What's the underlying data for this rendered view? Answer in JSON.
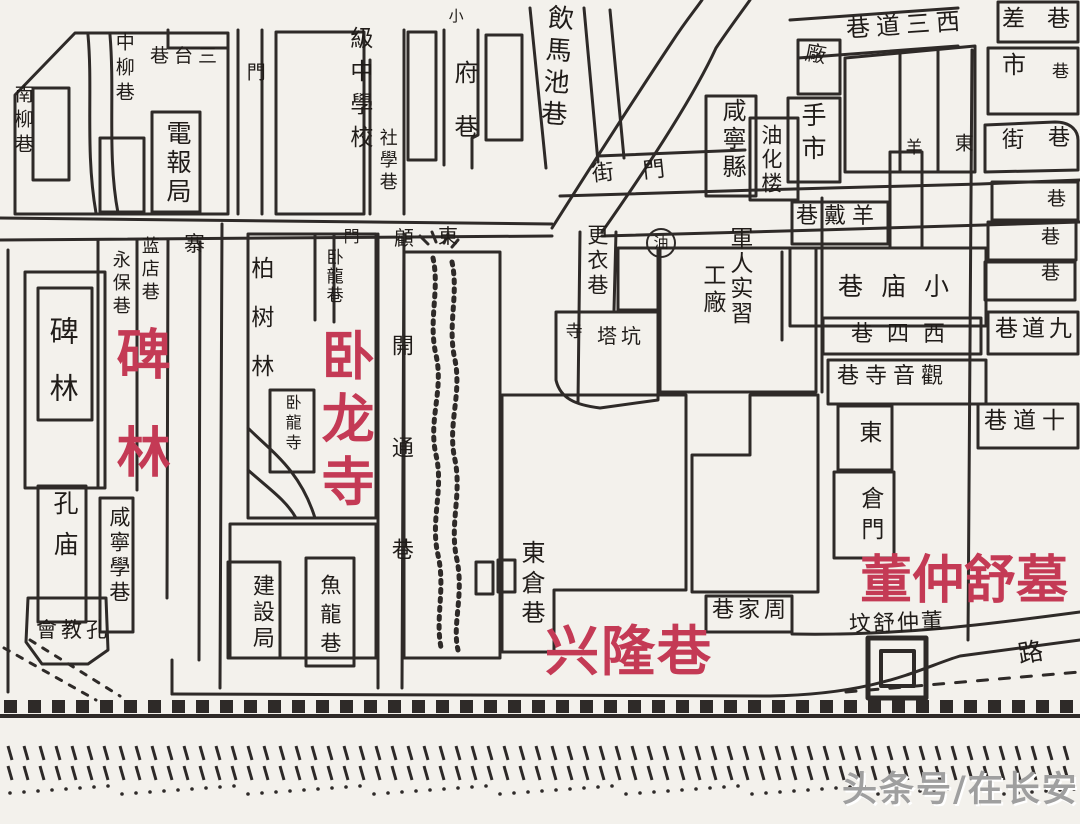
{
  "canvas": {
    "width": 1080,
    "height": 824
  },
  "colors": {
    "paper": "#f3f1ec",
    "ink": "#2e2a28",
    "label_ink": "#201c19",
    "red_annotation": "#c43a55",
    "watermark_gray": "#9f9f9f"
  },
  "watermark": {
    "text": "头条号/在长安"
  },
  "red_annotations": {
    "beilin": "碑林",
    "wolongsi": "卧龙寺",
    "xinglongxiang": "兴隆巷",
    "dongzhongshumu": "董仲舒墓"
  },
  "labels": [
    {
      "name": "label-nanliuxiang",
      "text": "南柳巷",
      "x": 12,
      "y": 84,
      "fs": 19,
      "dir": "v",
      "ls": 6
    },
    {
      "name": "label-zhongliuxiang",
      "text": "中柳巷",
      "x": 113,
      "y": 32,
      "fs": 19,
      "dir": "v",
      "ls": 6
    },
    {
      "name": "label-santaixiang",
      "text": "巷台三",
      "x": 150,
      "y": 47,
      "fs": 19,
      "dir": "h",
      "ls": 5
    },
    {
      "name": "label-dianbaoju",
      "text": "電報局",
      "x": 164,
      "y": 120,
      "fs": 25,
      "dir": "v",
      "ls": 4
    },
    {
      "name": "label-men-west",
      "text": "門",
      "x": 244,
      "y": 62,
      "fs": 19,
      "dir": "v"
    },
    {
      "name": "label-jizhongxuexiao",
      "text": "級中學校",
      "x": 346,
      "y": 26,
      "fs": 23,
      "dir": "v",
      "ls": 10
    },
    {
      "name": "label-shexuexiang",
      "text": "社學巷",
      "x": 377,
      "y": 128,
      "fs": 18,
      "dir": "v",
      "ls": 4
    },
    {
      "name": "label-xiao",
      "text": "小",
      "x": 447,
      "y": 8,
      "fs": 15,
      "dir": "v"
    },
    {
      "name": "label-fuxiang",
      "text": "府巷",
      "x": 451,
      "y": 60,
      "fs": 24,
      "dir": "v",
      "ls": 30
    },
    {
      "name": "label-yinmachixiang",
      "text": "飲馬池巷",
      "x": 541,
      "y": 4,
      "fs": 26,
      "dir": "v",
      "ls": 6,
      "rot": 4
    },
    {
      "name": "label-jie-street",
      "text": "街",
      "x": 592,
      "y": 163,
      "fs": 22,
      "dir": "h",
      "rot": -6
    },
    {
      "name": "label-men-street",
      "text": "門",
      "x": 643,
      "y": 160,
      "fs": 22,
      "dir": "h",
      "rot": -6
    },
    {
      "name": "label-xianningxian",
      "text": "咸寧縣",
      "x": 719,
      "y": 98,
      "fs": 24,
      "dir": "v",
      "ls": 4
    },
    {
      "name": "label-youhualou",
      "text": "油化楼",
      "x": 759,
      "y": 124,
      "fs": 21,
      "dir": "v",
      "ls": 3
    },
    {
      "name": "label-shoushi",
      "text": "手市",
      "x": 799,
      "y": 102,
      "fs": 25,
      "dir": "v",
      "ls": 8
    },
    {
      "name": "label-chang",
      "text": "廠",
      "x": 805,
      "y": 44,
      "fs": 21,
      "dir": "h",
      "rot": 10
    },
    {
      "name": "label-xisandaoxiang",
      "text": "巷道三西",
      "x": 846,
      "y": 13,
      "fs": 24,
      "dir": "h",
      "ls": 6,
      "rot": -4
    },
    {
      "name": "label-yang",
      "text": "羊",
      "x": 902,
      "y": 138,
      "fs": 17,
      "dir": "v"
    },
    {
      "name": "label-dong-strip",
      "text": "東",
      "x": 952,
      "y": 133,
      "fs": 19,
      "dir": "v"
    },
    {
      "name": "label-chaxiang",
      "text": "差巷",
      "x": 1002,
      "y": 8,
      "fs": 23,
      "dir": "h",
      "ls": 22
    },
    {
      "name": "label-shi-edge",
      "text": "市",
      "x": 1002,
      "y": 53,
      "fs": 24,
      "dir": "h"
    },
    {
      "name": "label-xiang-edge-1",
      "text": "巷",
      "x": 1052,
      "y": 64,
      "fs": 17,
      "dir": "h"
    },
    {
      "name": "label-jie-edge",
      "text": "街",
      "x": 1002,
      "y": 130,
      "fs": 22,
      "dir": "h"
    },
    {
      "name": "label-xiang-edge-2",
      "text": "巷",
      "x": 1048,
      "y": 128,
      "fs": 22,
      "dir": "h"
    },
    {
      "name": "label-xiang-edge-3",
      "text": "巷",
      "x": 1047,
      "y": 190,
      "fs": 19,
      "dir": "h"
    },
    {
      "name": "label-xiang-edge-4",
      "text": "巷",
      "x": 1041,
      "y": 228,
      "fs": 19,
      "dir": "h"
    },
    {
      "name": "label-xiang-edge-5",
      "text": "巷",
      "x": 1041,
      "y": 264,
      "fs": 19,
      "dir": "h"
    },
    {
      "name": "label-jiudaoxiang",
      "text": "巷道九",
      "x": 995,
      "y": 318,
      "fs": 23,
      "dir": "h",
      "ls": 4
    },
    {
      "name": "label-shidaoxiang",
      "text": "巷道十",
      "x": 984,
      "y": 410,
      "fs": 23,
      "dir": "h",
      "ls": 6
    },
    {
      "name": "label-yangdaixiang",
      "text": "巷戴羊",
      "x": 796,
      "y": 206,
      "fs": 22,
      "dir": "h",
      "ls": 6
    },
    {
      "name": "label-xiaomiaoxiang",
      "text": "巷庙小",
      "x": 838,
      "y": 274,
      "fs": 25,
      "dir": "h",
      "ls": 18
    },
    {
      "name": "label-xisixiang",
      "text": "巷四西",
      "x": 851,
      "y": 324,
      "fs": 22,
      "dir": "h",
      "ls": 14
    },
    {
      "name": "label-guanyinsixiang",
      "text": "巷寺音觀",
      "x": 837,
      "y": 366,
      "fs": 22,
      "dir": "h",
      "ls": 6
    },
    {
      "name": "label-dong-cang",
      "text": "東",
      "x": 855,
      "y": 420,
      "fs": 23,
      "dir": "v"
    },
    {
      "name": "label-cangmen",
      "text": "倉門",
      "x": 857,
      "y": 486,
      "fs": 23,
      "dir": "v",
      "ls": 8
    },
    {
      "name": "label-junrenshixi",
      "text": "軍人实習",
      "x": 726,
      "y": 226,
      "fs": 23,
      "dir": "v",
      "ls": 2
    },
    {
      "name": "label-gongchang",
      "text": "工廠",
      "x": 699,
      "y": 263,
      "fs": 23,
      "dir": "v",
      "ls": 4
    },
    {
      "name": "label-gengyixiang",
      "text": "更衣巷",
      "x": 585,
      "y": 224,
      "fs": 21,
      "dir": "v",
      "ls": 4
    },
    {
      "name": "label-si",
      "text": "寺",
      "x": 562,
      "y": 322,
      "fs": 17,
      "dir": "v"
    },
    {
      "name": "label-takeng",
      "text": "塔坑",
      "x": 597,
      "y": 326,
      "fs": 20,
      "dir": "h",
      "ls": 4
    },
    {
      "name": "label-zhai",
      "text": "寨",
      "x": 184,
      "y": 234,
      "fs": 21,
      "dir": "h"
    },
    {
      "name": "label-yongbaoxiang",
      "text": "永保巷",
      "x": 110,
      "y": 250,
      "fs": 18,
      "dir": "v",
      "ls": 5
    },
    {
      "name": "label-landianxiang",
      "text": "蓝店巷",
      "x": 139,
      "y": 236,
      "fs": 18,
      "dir": "v",
      "ls": 5
    },
    {
      "name": "label-beilin-ink",
      "text": "碑林",
      "x": 47,
      "y": 316,
      "fs": 29,
      "dir": "v",
      "ls": 28
    },
    {
      "name": "label-kongmiao",
      "text": "孔庙",
      "x": 51,
      "y": 490,
      "fs": 25,
      "dir": "v",
      "ls": 16
    },
    {
      "name": "label-xianningxuexiang",
      "text": "咸寧學巷",
      "x": 107,
      "y": 506,
      "fs": 21,
      "dir": "v",
      "ls": 4
    },
    {
      "name": "label-kongjiaohui",
      "text": "會教孔",
      "x": 36,
      "y": 620,
      "fs": 21,
      "dir": "h",
      "ls": 4
    },
    {
      "name": "label-baishulin",
      "text": "柏树林",
      "x": 247,
      "y": 256,
      "fs": 23,
      "dir": "v",
      "ls": 26
    },
    {
      "name": "label-wolongxiang",
      "text": "卧龍巷",
      "x": 323,
      "y": 248,
      "fs": 17,
      "dir": "v",
      "ls": 2
    },
    {
      "name": "label-men-wolong",
      "text": "門",
      "x": 341,
      "y": 228,
      "fs": 16,
      "dir": "v"
    },
    {
      "name": "label-wolongsi-ink",
      "text": "卧龍寺",
      "x": 283,
      "y": 394,
      "fs": 16,
      "dir": "v",
      "ls": 4
    },
    {
      "name": "label-gu",
      "text": "顧",
      "x": 394,
      "y": 228,
      "fs": 20,
      "dir": "h"
    },
    {
      "name": "label-dong-street",
      "text": "東",
      "x": 438,
      "y": 226,
      "fs": 20,
      "dir": "h"
    },
    {
      "name": "label-kaitongxiang",
      "text": "開通巷",
      "x": 388,
      "y": 334,
      "fs": 22,
      "dir": "v",
      "ls": 80
    },
    {
      "name": "label-jiansheju",
      "text": "建設局",
      "x": 249,
      "y": 574,
      "fs": 22,
      "dir": "v",
      "ls": 4
    },
    {
      "name": "label-yulongxiang",
      "text": "魚龍巷",
      "x": 318,
      "y": 574,
      "fs": 21,
      "dir": "v",
      "ls": 8
    },
    {
      "name": "label-dongcangxiang",
      "text": "東倉巷",
      "x": 518,
      "y": 540,
      "fs": 24,
      "dir": "v",
      "ls": 6
    },
    {
      "name": "label-zhoujiaxiang",
      "text": "巷家周",
      "x": 712,
      "y": 600,
      "fs": 22,
      "dir": "h",
      "ls": 4
    },
    {
      "name": "label-dongzhongshufen",
      "text": "坟舒仲董",
      "x": 849,
      "y": 613,
      "fs": 22,
      "dir": "h",
      "ls": 2,
      "rot": -2
    },
    {
      "name": "label-lu",
      "text": "路",
      "x": 1018,
      "y": 640,
      "fs": 25,
      "dir": "h",
      "rot": -10
    },
    {
      "name": "well-glyph",
      "text": "油",
      "x": 646,
      "y": 228,
      "fs": 15,
      "dir": "h",
      "circ": true
    },
    {
      "name": "red-label-beilin",
      "text": "碑林",
      "x": 110,
      "y": 326,
      "fs": 54,
      "dir": "v",
      "ls": 44,
      "style": "red"
    },
    {
      "name": "red-label-wolongsi",
      "text": "卧龙寺",
      "x": 316,
      "y": 328,
      "fs": 53,
      "dir": "v",
      "ls": 10,
      "style": "red"
    },
    {
      "name": "red-label-xinglongxiang",
      "text": "兴隆巷",
      "x": 545,
      "y": 624,
      "fs": 54,
      "dir": "h",
      "ls": 2,
      "style": "red"
    },
    {
      "name": "red-label-dongzhongshumu",
      "text": "董仲舒墓",
      "x": 860,
      "y": 554,
      "fs": 52,
      "dir": "h",
      "style": "red"
    }
  ]
}
